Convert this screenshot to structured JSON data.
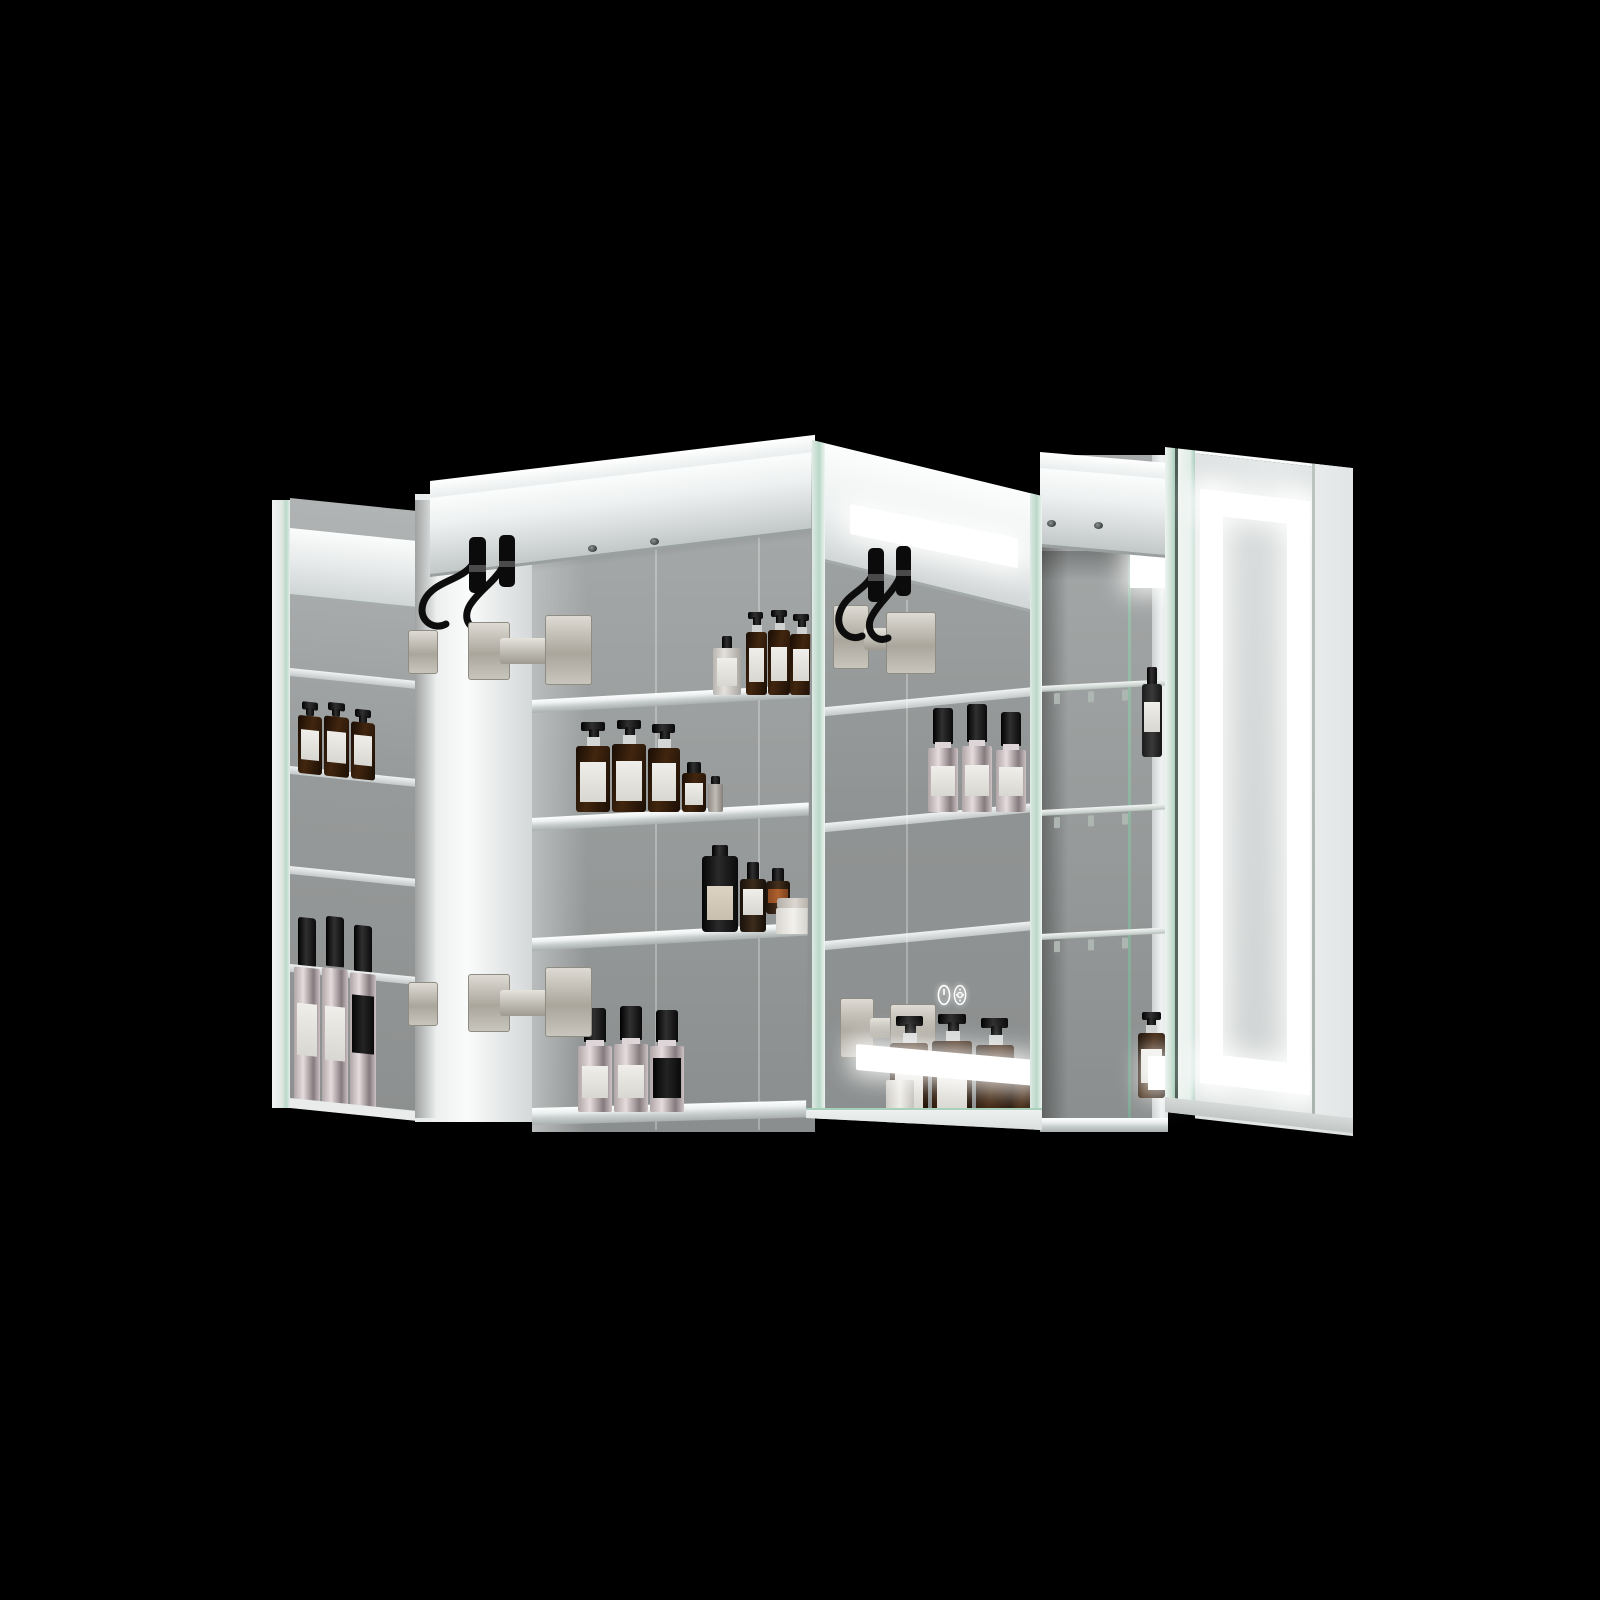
{
  "scene": {
    "type": "3d-product-render",
    "subject": "LED lighted bathroom mirror medicine cabinet with three open mirrored doors",
    "background": "#000000"
  },
  "colors": {
    "bg": "#000000",
    "led": "#ffffff",
    "mirror_top": "#a7aaaa",
    "mirror_bottom": "#8b8e8e",
    "frame": "#f3f5f5",
    "frame_shade": "#c9cdcd",
    "glass_green": "#a9d0bd",
    "amber": "#3a2210",
    "chrome": "#cfc4c6",
    "hinge_nickel": "#c9c5bc",
    "cable": "#0d0d0d",
    "label": "#eae8e3"
  },
  "cabinet": {
    "doors": [
      {
        "id": "left-door",
        "state": "open",
        "view": "mirrored back reflecting interior shelves and bottles"
      },
      {
        "id": "middle-door",
        "state": "open",
        "view": "mirrored back reflecting LED strips, hinges and bottles"
      },
      {
        "id": "right-door",
        "state": "open",
        "view": "front face with illuminated LED frame",
        "led_frame": true
      }
    ],
    "left_bay": {
      "shelves": 3,
      "shelf_type": "framed",
      "bottle_groups": [
        {
          "shelf": 1,
          "items": [
            "small perfume bottle",
            "3 amber pump bottles"
          ]
        },
        {
          "shelf": 2,
          "items": [
            "3 amber pump bottles",
            "small amber bottle",
            "small gray bottle"
          ]
        },
        {
          "shelf": 3,
          "items": [
            "black bottle",
            "2 dropper bottles",
            "white jar"
          ]
        },
        {
          "shelf": "bottom",
          "items": [
            "3 chrome spray bottles"
          ]
        }
      ]
    },
    "right_bay": {
      "shelves": 3,
      "shelf_type": "glass with clips",
      "items": [
        "dropper bottle",
        "amber pump bottle"
      ]
    },
    "hardware": {
      "hinge_clusters": 4,
      "cable_connectors": 4,
      "rail_screws": 4
    },
    "touch_controls": {
      "buttons": [
        {
          "icon": "power-icon"
        },
        {
          "icon": "brightness-icon"
        }
      ]
    }
  },
  "lighting": {
    "led_color": "#ffffff",
    "strips": [
      "reflected top LED bar",
      "reflected bottom LED bar",
      "right door LED frame",
      "reflected LED squares"
    ]
  }
}
